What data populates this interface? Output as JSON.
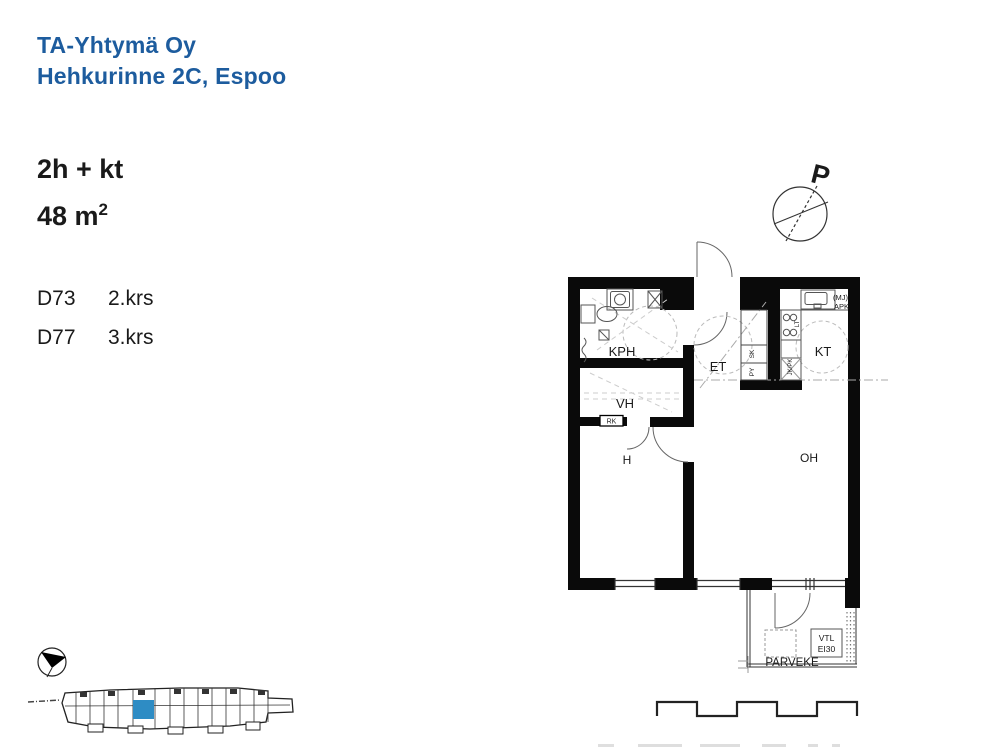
{
  "header": {
    "company": "TA-Yhtymä Oy",
    "address": "Hehkurinne 2C, Espoo"
  },
  "apartment": {
    "type": "2h + kt",
    "area_base": "48 m",
    "area_exp": "2"
  },
  "units": [
    {
      "id": "D73",
      "floor": "2.krs"
    },
    {
      "id": "D77",
      "floor": "3.krs"
    }
  ],
  "plan": {
    "north_label": "P",
    "rooms": {
      "kph": "KPH",
      "vh": "VH",
      "h": "H",
      "et": "ET",
      "kt": "KT",
      "oh": "OH",
      "parveke": "PARVEKE"
    },
    "labels": {
      "rk": "RK",
      "sk": "SK",
      "py": "PY",
      "lt": "LT",
      "jk_pk": "JK/PK",
      "mj": "(MJ)",
      "apk": "APK",
      "vtl": "VTL",
      "ei30": "EI30"
    }
  },
  "colors": {
    "brand_blue": "#1d5c9e",
    "unit_highlight": "#2e8cc4",
    "wall_black": "#0a0a0a",
    "line_gray": "#999999"
  }
}
